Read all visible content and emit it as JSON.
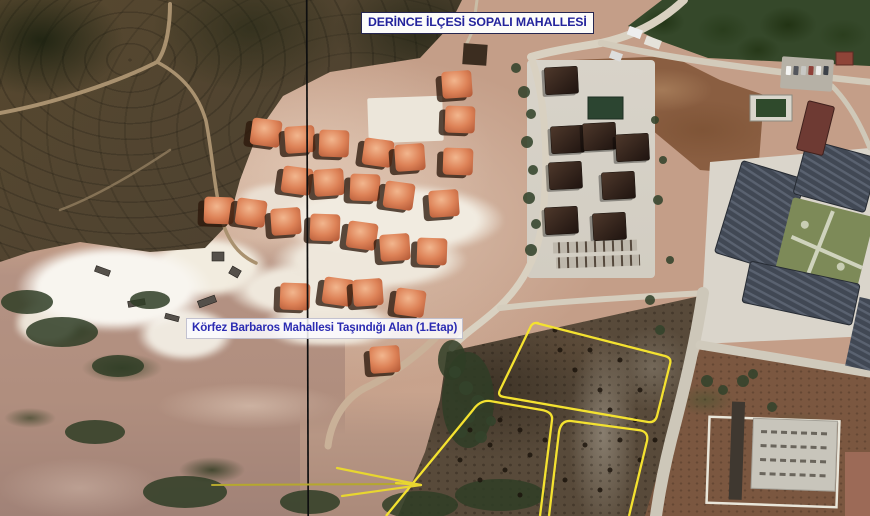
{
  "annotations": {
    "top_label": "DERİNCE İLÇESİ SOPALI MAHALLESİ",
    "area_label": "Körfez Barbaros Mahallesi Taşındığı Alan (1.Etap)"
  },
  "colors": {
    "plot_outline_yellow": "#f4e230",
    "arrow_yellow": "#d8c72c",
    "label_text_blue": "#2a2aa0",
    "label_background": "#ffffff",
    "divider_line_black": "#101010"
  }
}
